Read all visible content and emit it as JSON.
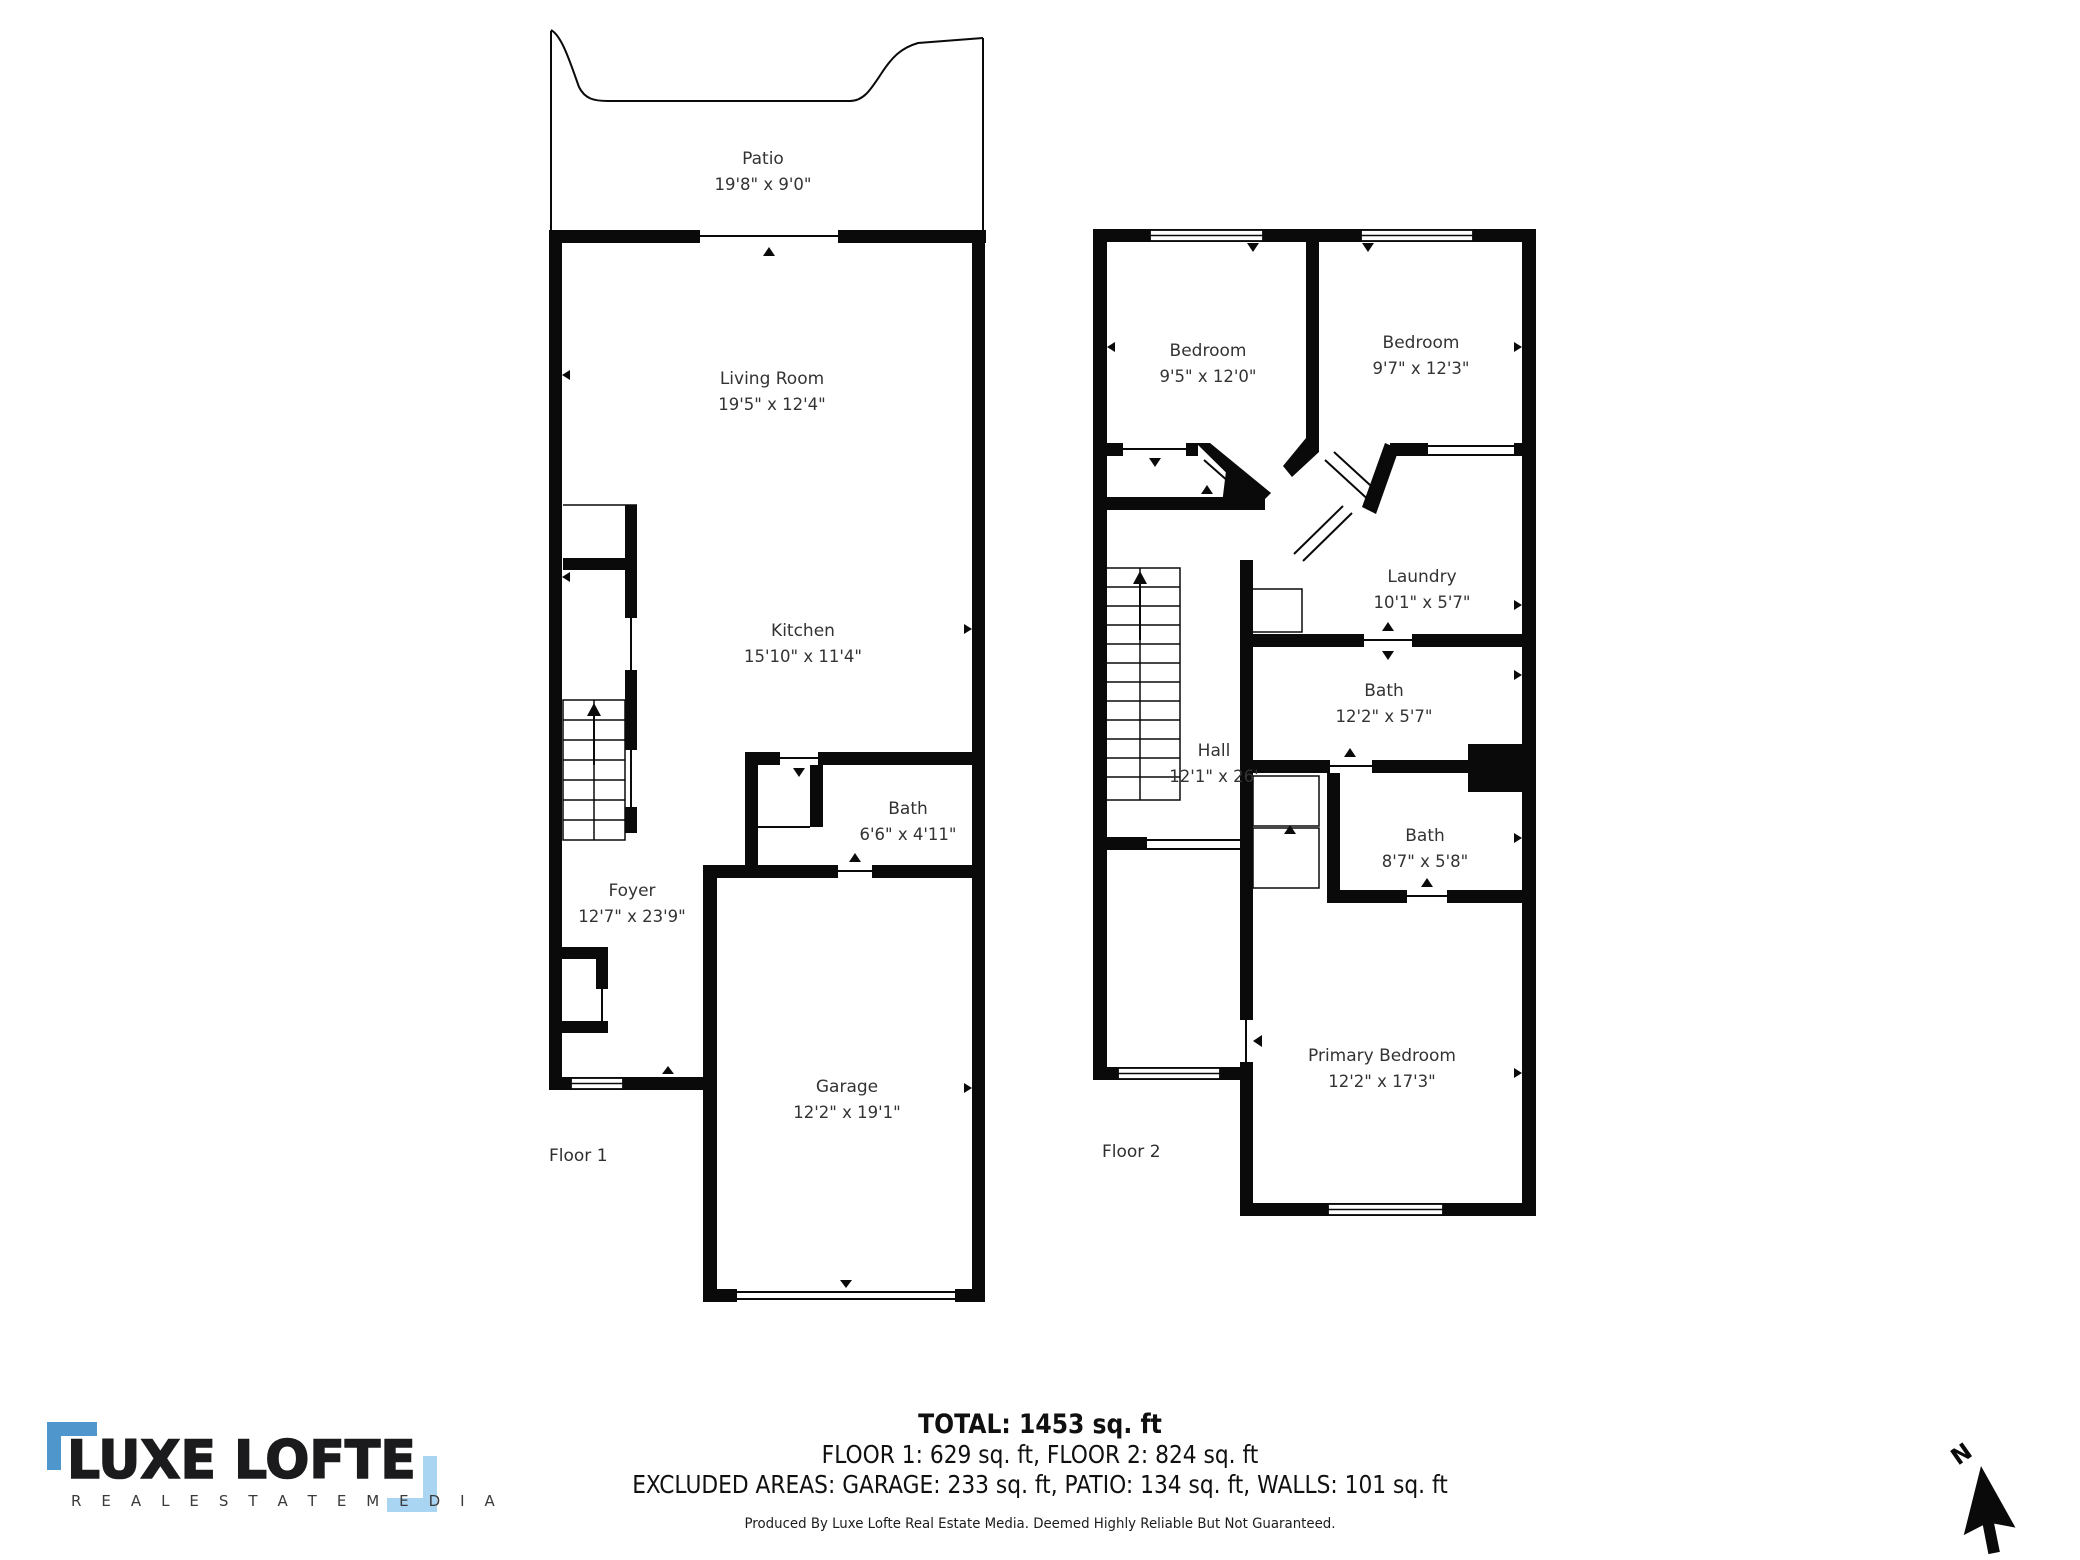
{
  "floors": [
    {
      "label": "Floor 1",
      "rooms": [
        {
          "name": "Patio",
          "dims": "19'8\" x 9'0\""
        },
        {
          "name": "Living Room",
          "dims": "19'5\" x 12'4\""
        },
        {
          "name": "Kitchen",
          "dims": "15'10\" x 11'4\""
        },
        {
          "name": "Bath",
          "dims": "6'6\" x 4'11\""
        },
        {
          "name": "Foyer",
          "dims": "12'7\" x 23'9\""
        },
        {
          "name": "Garage",
          "dims": "12'2\" x 19'1\""
        }
      ]
    },
    {
      "label": "Floor 2",
      "rooms": [
        {
          "name": "Bedroom",
          "dims": "9'5\" x 12'0\""
        },
        {
          "name": "Bedroom",
          "dims": "9'7\" x 12'3\""
        },
        {
          "name": "Laundry",
          "dims": "10'1\" x 5'7\""
        },
        {
          "name": "Bath",
          "dims": "12'2\" x 5'7\""
        },
        {
          "name": "Hall",
          "dims": "12'1\" x 26'"
        },
        {
          "name": "Bath",
          "dims": "8'7\" x 5'8\""
        },
        {
          "name": "Primary Bedroom",
          "dims": "12'2\" x 17'3\""
        }
      ]
    }
  ],
  "summary": {
    "total": "TOTAL: 1453 sq. ft",
    "floors_line": "FLOOR 1: 629 sq. ft, FLOOR 2: 824 sq. ft",
    "excluded_line": "EXCLUDED AREAS: GARAGE: 233 sq. ft, PATIO: 134 sq. ft, WALLS: 101 sq. ft",
    "disclaimer": "Produced By Luxe Lofte Real Estate Media. Deemed Highly Reliable But Not Guaranteed."
  },
  "logo": {
    "name": "LUXE LOFTE",
    "tagline": "R E A L   E S T A T E   M E D I A",
    "accent_dark": "#4e96cb",
    "accent_light": "#a9d5f2"
  },
  "compass": {
    "label": "N"
  }
}
